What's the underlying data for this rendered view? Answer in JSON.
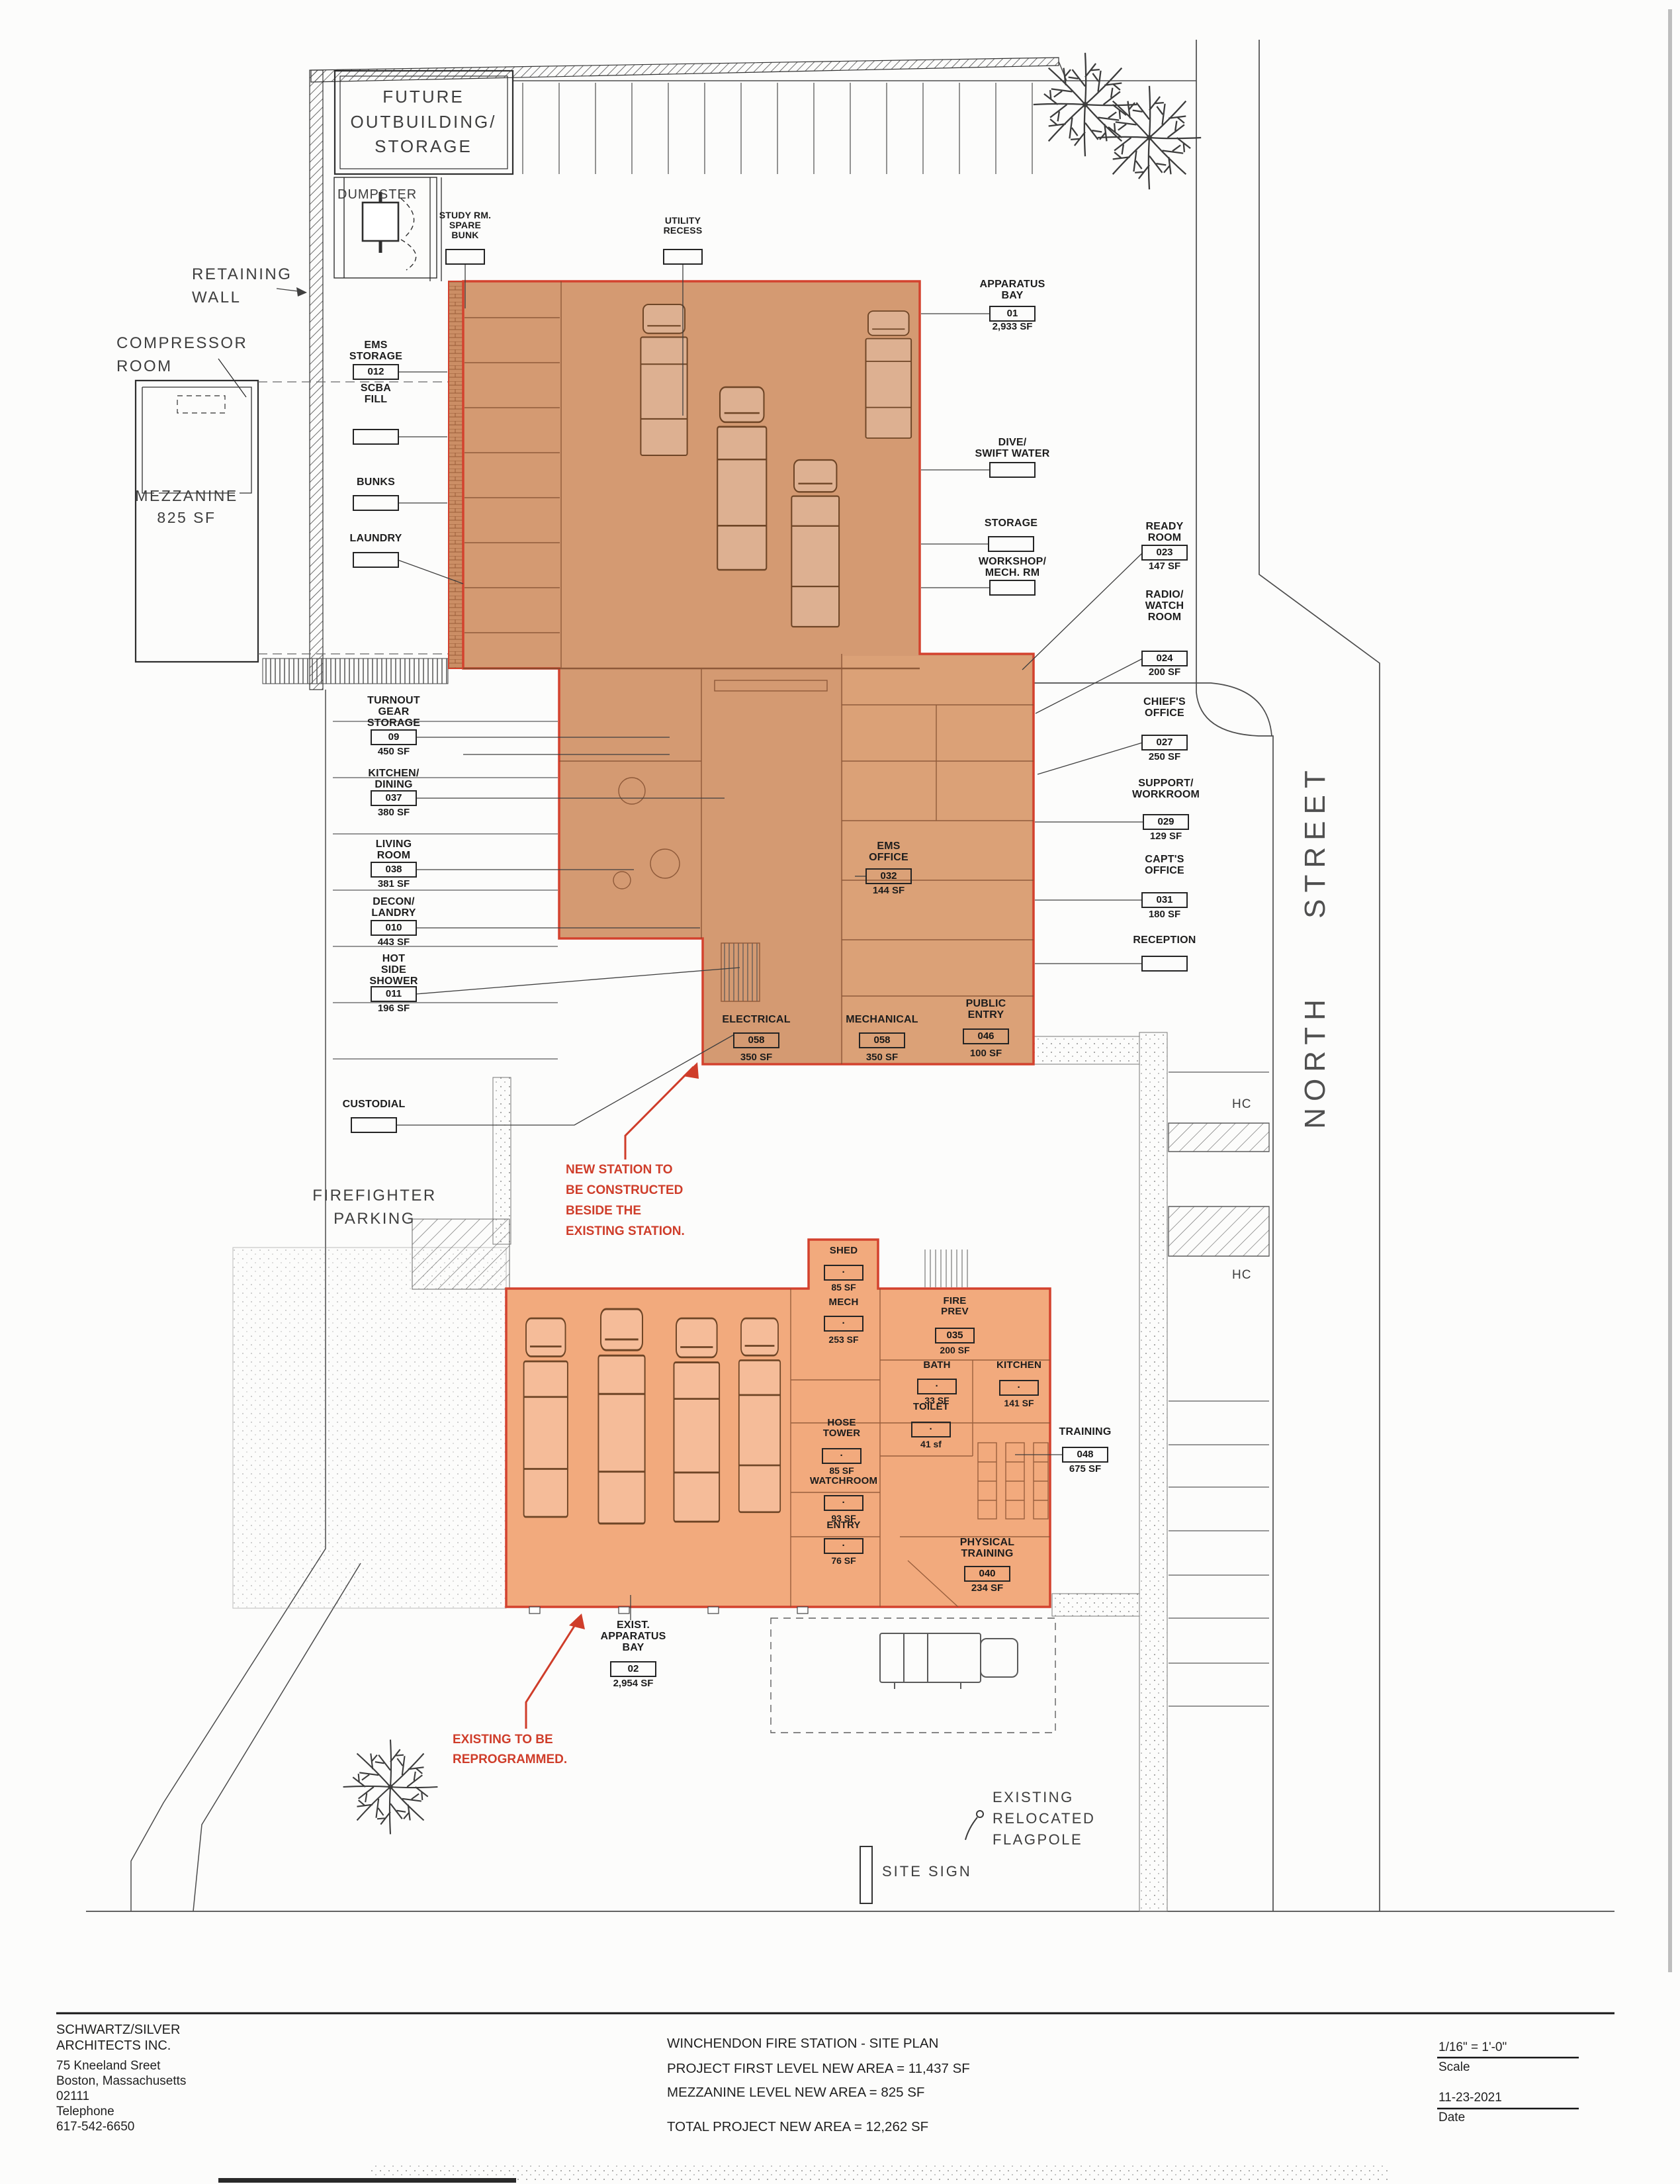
{
  "colors": {
    "highlight_red": "#d3422e",
    "new_station_fill": "#d49a72",
    "existing_station_fill": "#f2aa7d",
    "annotation_red": "#cf3d2a"
  },
  "site": {
    "street": "NORTH STREET",
    "hc": "HC",
    "site_sign": "SITE SIGN",
    "flagpole_note": "EXISTING\nRELOCATED\nFLAGPOLE",
    "future_outbuilding": "FUTURE\nOUTBUILDING/\nSTORAGE",
    "dumpster": "DUMPSTER",
    "retaining_wall": "RETAINING\nWALL",
    "compressor_room": "COMPRESSOR\nROOM",
    "mezzanine": "MEZZANINE\n825 SF",
    "firefighter_parking": "FIREFIGHTER\nPARKING"
  },
  "notes": {
    "new_station": "NEW STATION TO\nBE CONSTRUCTED\nBESIDE THE\nEXISTING STATION.",
    "existing_station": "EXISTING TO BE\nREPROGRAMMED."
  },
  "rooms": {
    "study_room": {
      "name": "STUDY RM.\nSPARE\nBUNK",
      "num": ""
    },
    "utility_recess": {
      "name": "UTILITY\nRECESS",
      "num": ""
    },
    "apparatus_bay": {
      "name": "APPARATUS\nBAY",
      "num": "01",
      "area": "2,933 SF"
    },
    "ems_storage": {
      "name": "EMS\nSTORAGE",
      "num": "012"
    },
    "scba_fill": {
      "name": "SCBA\nFILL",
      "num": ""
    },
    "bunks": {
      "name": "BUNKS",
      "num": ""
    },
    "laundry": {
      "name": "LAUNDRY",
      "num": ""
    },
    "dive_swift_water": {
      "name": "DIVE/\nSWIFT WATER",
      "num": ""
    },
    "storage": {
      "name": "STORAGE",
      "num": ""
    },
    "workshop_mech": {
      "name": "WORKSHOP/\nMECH. RM",
      "num": ""
    },
    "ready_room": {
      "name": "READY\nROOM",
      "num": "023",
      "area": "147 SF"
    },
    "radio_watch_room": {
      "name": "RADIO/\nWATCH\nROOM",
      "num": "024",
      "area": "200 SF"
    },
    "chiefs_office": {
      "name": "CHIEF'S\nOFFICE",
      "num": "027",
      "area": "250 SF"
    },
    "support_workroom": {
      "name": "SUPPORT/\nWORKROOM",
      "num": "029",
      "area": "129 SF"
    },
    "capts_office": {
      "name": "CAPT'S\nOFFICE",
      "num": "031",
      "area": "180 SF"
    },
    "reception": {
      "name": "RECEPTION",
      "num": ""
    },
    "turnout_gear": {
      "name": "TURNOUT\nGEAR\nSTORAGE",
      "num": "09",
      "area": "450 SF"
    },
    "kitchen_dining": {
      "name": "KITCHEN/\nDINING",
      "num": "037",
      "area": "380 SF"
    },
    "living_room": {
      "name": "LIVING\nROOM",
      "num": "038",
      "area": "381 SF"
    },
    "decon_landry": {
      "name": "DECON/\nLANDRY",
      "num": "010",
      "area": "443 SF"
    },
    "hot_side_shower": {
      "name": "HOT\nSIDE\nSHOWER",
      "num": "011",
      "area": "196 SF"
    },
    "custodial": {
      "name": "CUSTODIAL",
      "num": ""
    },
    "ems_office": {
      "name": "EMS\nOFFICE",
      "num": "032",
      "area": "144 SF"
    },
    "electrical": {
      "name": "ELECTRICAL",
      "num": "058",
      "area": "350 SF"
    },
    "mechanical": {
      "name": "MECHANICAL",
      "num": "058",
      "area": "350 SF"
    },
    "public_entry": {
      "name": "PUBLIC\nENTRY",
      "num": "046",
      "area": "100 SF"
    },
    "shed": {
      "name": "SHED",
      "num": "·",
      "area": "85 SF"
    },
    "mech": {
      "name": "MECH",
      "num": "·",
      "area": "253 SF"
    },
    "fire_prev": {
      "name": "FIRE\nPREV",
      "num": "035",
      "area": "200 SF"
    },
    "bath": {
      "name": "BATH",
      "num": "·",
      "area": "33 SF"
    },
    "kitchen": {
      "name": "KITCHEN",
      "num": "·",
      "area": "141 SF"
    },
    "toilet": {
      "name": "TOILET",
      "num": "·",
      "area": "41 sf"
    },
    "hose_tower": {
      "name": "HOSE\nTOWER",
      "num": "·",
      "area": "85 SF"
    },
    "watchroom": {
      "name": "WATCHROOM",
      "num": "·",
      "area": "93 SF"
    },
    "entry": {
      "name": "ENTRY",
      "num": "·",
      "area": "76 SF"
    },
    "training": {
      "name": "TRAINING",
      "num": "048",
      "area": "675 SF"
    },
    "physical_training": {
      "name": "PHYSICAL\nTRAINING",
      "num": "040",
      "area": "234 SF"
    },
    "exist_apparatus_bay": {
      "name": "EXIST.\nAPPARATUS\nBAY",
      "num": "02",
      "area": "2,954 SF"
    }
  },
  "title_block": {
    "firm": "SCHWARTZ/SILVER\nARCHITECTS INC.",
    "address": "75 Kneeland Sreet\nBoston, Massachusetts\n02111\nTelephone\n617-542-6650",
    "drawing_title": "WINCHENDON FIRE STATION - SITE PLAN",
    "area_first_level": "PROJECT FIRST LEVEL NEW AREA = 11,437 SF",
    "area_mezzanine": "MEZZANINE LEVEL NEW AREA = 825 SF",
    "area_total": "TOTAL PROJECT NEW AREA  = 12,262 SF",
    "scale_value": "1/16\" = 1'-0\"",
    "scale_label": "Scale",
    "date_value": "11-23-2021",
    "date_label": "Date"
  }
}
